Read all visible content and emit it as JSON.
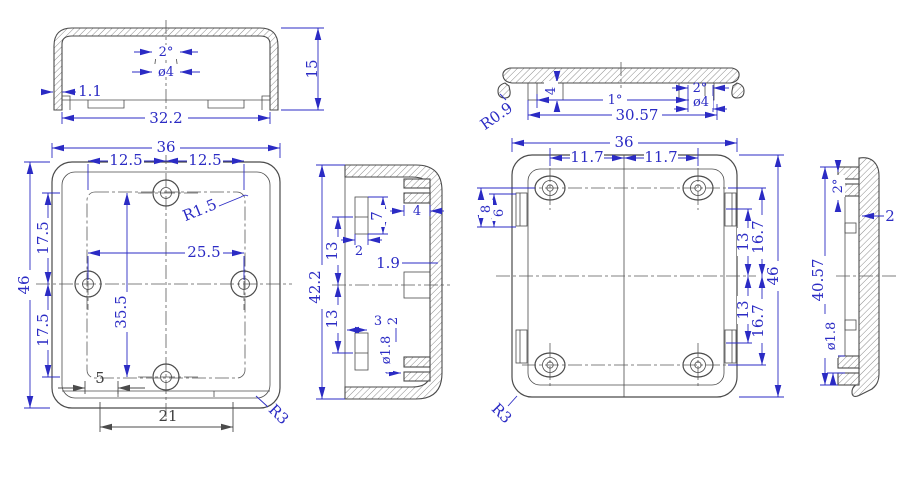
{
  "drawing_title": "enclosure-technical-drawing",
  "colors": {
    "background": "#ffffff",
    "geometry": "#4b4b4b",
    "dimension_blue": "#2b2bc4",
    "dimension_dark": "#3f3f3f"
  },
  "views": {
    "cover_section": {
      "label": "cover cross section",
      "dims": {
        "draft_angle": "2°",
        "boss_diameter": "ø4",
        "wall_thickness": "1.1",
        "inner_width": "32.2",
        "height": "15"
      }
    },
    "cover_front": {
      "label": "cover front view",
      "dims": {
        "overall_width": "36",
        "hole_offset_left": "12.5",
        "hole_offset_right": "12.5",
        "inner_fillet": "R1.5",
        "hole_span_h": "25.5",
        "hole_offset_top": "17.5",
        "hole_offset_bottom": "17.5",
        "overall_height": "46",
        "hole_span_v": "35.5",
        "notch_offset": "5",
        "notch_width": "21",
        "corner_radius": "R3"
      }
    },
    "cover_side_section": {
      "label": "cover side section",
      "dims": {
        "inner_height": "42.2",
        "boss_offset_top": "13",
        "boss_offset_bottom": "13",
        "slot_height": "7",
        "slot_width": "2",
        "rib_width": "4",
        "wall_thickness": "1.9",
        "boss_depth": "3",
        "boss_width": "2",
        "pin_hole": "ø1.8"
      }
    },
    "base_section": {
      "label": "base cross section",
      "dims": {
        "corner_radius": "R0.9",
        "rim_height": "4",
        "wall_draft": "1°",
        "boss_draft": "2°",
        "inner_width": "30.57",
        "boss_diameter": "ø4"
      }
    },
    "base_front": {
      "label": "base front view",
      "dims": {
        "overall_width": "36",
        "hole_offset_left": "11.7",
        "hole_offset_right": "11.7",
        "tab_span": "8",
        "tab_length": "6",
        "rib_offset_top": "13",
        "hole_offset_top": "16.7",
        "rib_offset_bottom": "13",
        "hole_offset_bottom": "16.7",
        "overall_height": "46",
        "corner_radius": "R3"
      }
    },
    "base_side_section": {
      "label": "base side section",
      "dims": {
        "draft_angle": "2°",
        "wall_thickness": "2",
        "inner_height": "40.57",
        "pin_hole": "ø1.8"
      }
    }
  }
}
